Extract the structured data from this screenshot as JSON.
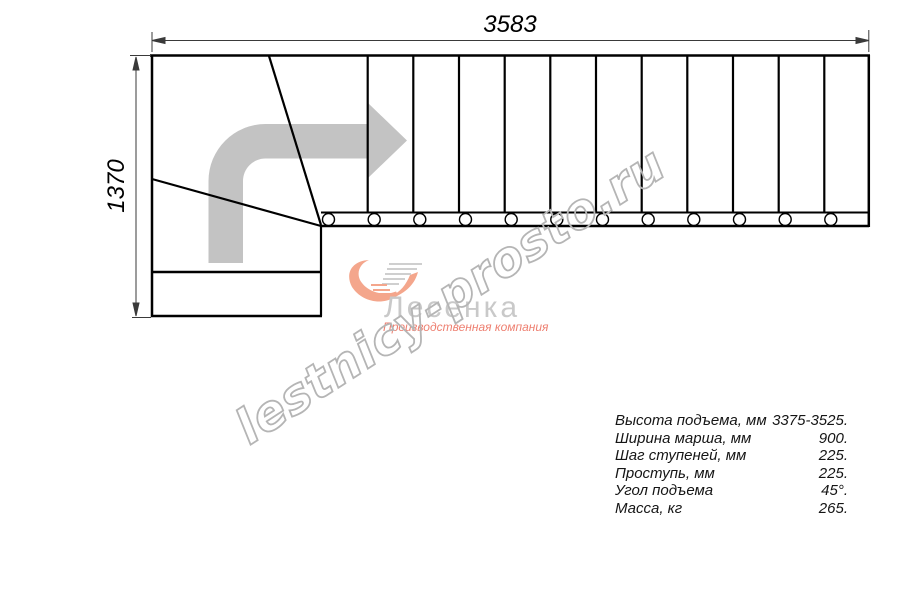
{
  "drawing": {
    "width_dimension_label": "3583",
    "height_dimension_label": "1370",
    "treads_count": 12,
    "balusters_count": 12,
    "line_color": "#000000",
    "arrow_color": "#c3c3c3"
  },
  "watermark": {
    "text": "lestnicy-prosto.ru",
    "color": "#b5b5b5"
  },
  "logo": {
    "brand": "Лесенка",
    "tagline": "Производственная компания",
    "brand_color": "#c9c9c9",
    "accent_color": "#f4a68c"
  },
  "specs": {
    "rows": [
      {
        "label": "Высота подъема, мм",
        "value": "3375-3525."
      },
      {
        "label": "Ширина марша, мм",
        "value": "900."
      },
      {
        "label": "Шаг ступеней, мм",
        "value": "225."
      },
      {
        "label": "Проступь, мм",
        "value": "225."
      },
      {
        "label": "Угол подъема",
        "value": "45°."
      },
      {
        "label": "Масса, кг",
        "value": "265."
      }
    ]
  }
}
